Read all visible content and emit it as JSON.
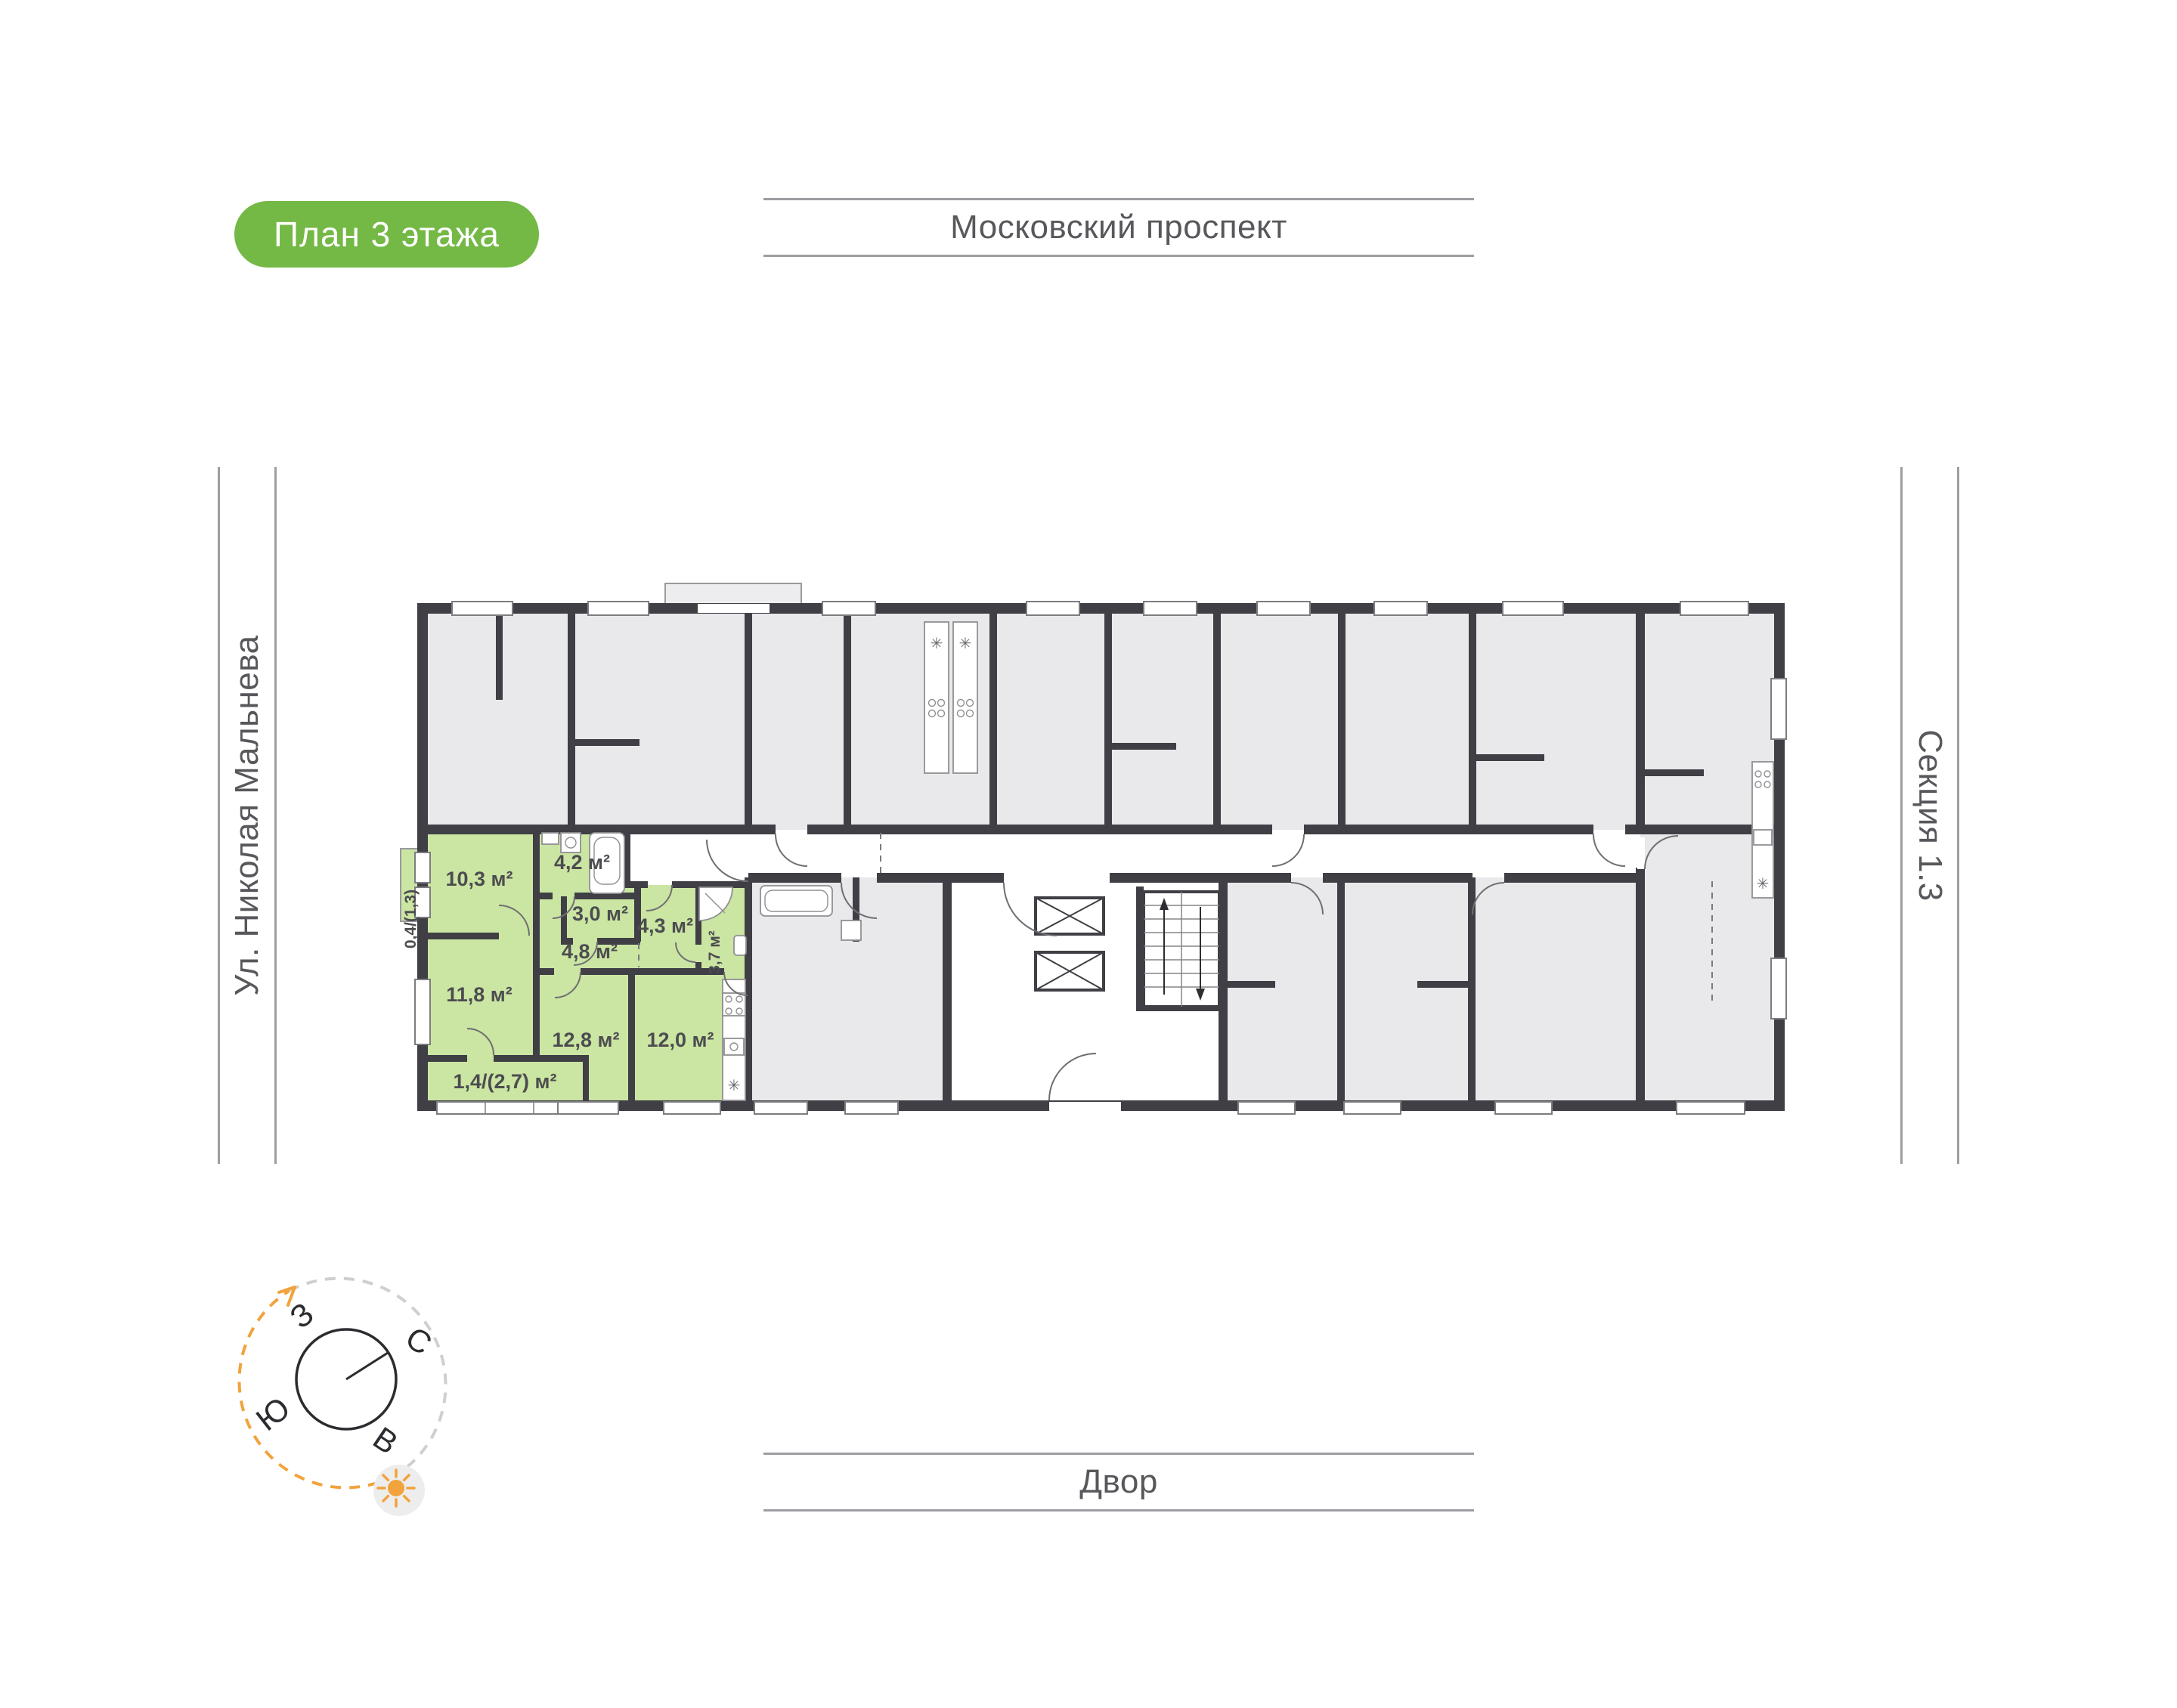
{
  "badge": {
    "label": "План 3 этажа"
  },
  "surroundings": {
    "top": "Московский проспект",
    "left": "Ул. Николая Мальнева",
    "right": "Секция 1.3",
    "bottom": "Двор"
  },
  "compass": {
    "west": "З",
    "north": "С",
    "south": "Ю",
    "east": "В"
  },
  "plan": {
    "title": "Floor plan, section 1.3, floor 3",
    "highlighted_unit": {
      "rooms": [
        {
          "id": "hall-entry",
          "label": "10,3 м²"
        },
        {
          "id": "bathroom-1",
          "label": "4,2 м²"
        },
        {
          "id": "wardrobe",
          "label": "3,0 м²"
        },
        {
          "id": "hallway",
          "label": "4,8 м²"
        },
        {
          "id": "corridor",
          "label": "4,3 м²"
        },
        {
          "id": "bathroom-2",
          "label": "3,7 м²"
        },
        {
          "id": "bedroom-1",
          "label": "11,8 м²"
        },
        {
          "id": "bedroom-2",
          "label": "12,8 м²"
        },
        {
          "id": "kitchen",
          "label": "12,0 м²"
        },
        {
          "id": "balcony-south",
          "label": "1,4/(2,7) м²"
        },
        {
          "id": "balcony-west",
          "label": "0,4/(1,3)"
        }
      ]
    },
    "colors": {
      "highlight_green": "#CBE5A3",
      "badge_green": "#74B845",
      "wall_dark": "#3F3F45",
      "room_gray": "#E9E9EB",
      "compass_orange": "#F2A33C"
    }
  }
}
